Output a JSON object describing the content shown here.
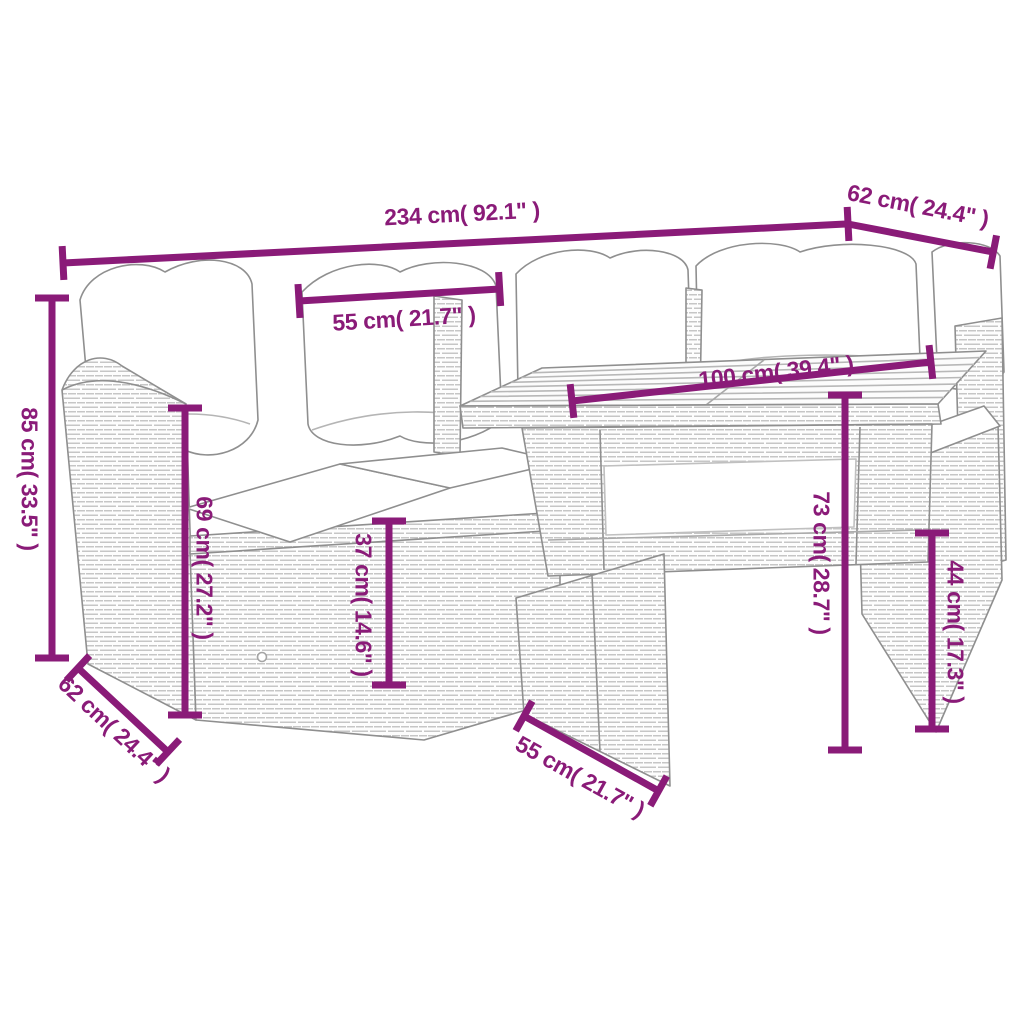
{
  "diagram": {
    "type": "product-dimension-diagram",
    "subject": "poly-rattan-garden-sofa-set-with-table-and-cushions",
    "accent_color": "#8a1b78",
    "outline_color": "#8f8f8f",
    "background_color": "#ffffff",
    "dimensions": [
      {
        "id": "total-width",
        "label": "234 cm( 92.1\" )"
      },
      {
        "id": "depth-right",
        "label": "62 cm( 24.4\" )"
      },
      {
        "id": "cushion-width",
        "label": "55 cm( 21.7\" )"
      },
      {
        "id": "table-length",
        "label": "100 cm( 39.4\" )"
      },
      {
        "id": "total-height",
        "label": "85 cm( 33.5\" )"
      },
      {
        "id": "back-height",
        "label": "69 cm( 27.2\" )"
      },
      {
        "id": "seat-height",
        "label": "37 cm( 14.6\" )"
      },
      {
        "id": "table-height",
        "label": "73 cm( 28.7\" )"
      },
      {
        "id": "stool-height",
        "label": "44 cm( 17.3\" )"
      },
      {
        "id": "depth-left",
        "label": "62 cm( 24.4\" )"
      },
      {
        "id": "stool-width",
        "label": "55 cm( 21.7\" )"
      }
    ]
  }
}
